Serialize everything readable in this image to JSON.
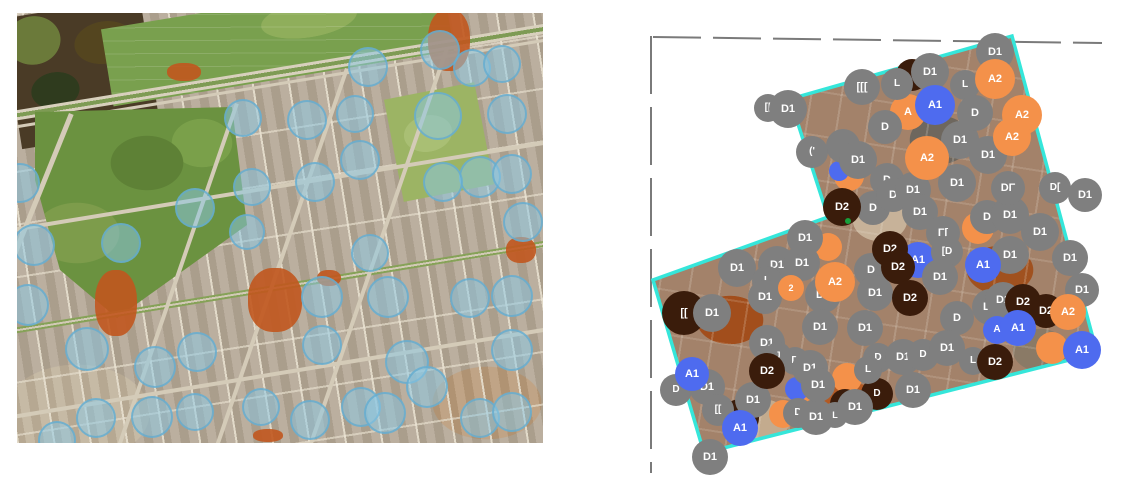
{
  "figure": {
    "left_map": {
      "sample_circle_fill": "rgba(138,200,229,0.52)",
      "sample_circle_edge": "rgba(96,170,206,0.75)",
      "sample_circles": [
        {
          "x": 351,
          "y": 54,
          "r": 20
        },
        {
          "x": 423,
          "y": 37,
          "r": 20
        },
        {
          "x": 455,
          "y": 55,
          "r": 19
        },
        {
          "x": 485,
          "y": 51,
          "r": 19
        },
        {
          "x": 490,
          "y": 101,
          "r": 20
        },
        {
          "x": 226,
          "y": 105,
          "r": 19
        },
        {
          "x": 290,
          "y": 107,
          "r": 20
        },
        {
          "x": 338,
          "y": 101,
          "r": 19
        },
        {
          "x": 421,
          "y": 103,
          "r": 24
        },
        {
          "x": 343,
          "y": 147,
          "r": 20
        },
        {
          "x": 463,
          "y": 164,
          "r": 21
        },
        {
          "x": 426,
          "y": 169,
          "r": 20
        },
        {
          "x": 495,
          "y": 161,
          "r": 20
        },
        {
          "x": 298,
          "y": 169,
          "r": 20
        },
        {
          "x": 235,
          "y": 174,
          "r": 19
        },
        {
          "x": 178,
          "y": 195,
          "r": 20
        },
        {
          "x": 3,
          "y": 170,
          "r": 20
        },
        {
          "x": 104,
          "y": 230,
          "r": 20
        },
        {
          "x": 17,
          "y": 232,
          "r": 21
        },
        {
          "x": 230,
          "y": 219,
          "r": 18
        },
        {
          "x": 11,
          "y": 292,
          "r": 21
        },
        {
          "x": 70,
          "y": 336,
          "r": 22
        },
        {
          "x": 138,
          "y": 354,
          "r": 21
        },
        {
          "x": 180,
          "y": 339,
          "r": 20
        },
        {
          "x": 79,
          "y": 405,
          "r": 20
        },
        {
          "x": 135,
          "y": 404,
          "r": 21
        },
        {
          "x": 178,
          "y": 399,
          "r": 19
        },
        {
          "x": 244,
          "y": 394,
          "r": 19
        },
        {
          "x": 293,
          "y": 407,
          "r": 20
        },
        {
          "x": 344,
          "y": 394,
          "r": 20
        },
        {
          "x": 305,
          "y": 332,
          "r": 20
        },
        {
          "x": 305,
          "y": 284,
          "r": 21
        },
        {
          "x": 371,
          "y": 284,
          "r": 21
        },
        {
          "x": 453,
          "y": 285,
          "r": 20
        },
        {
          "x": 495,
          "y": 283,
          "r": 21
        },
        {
          "x": 390,
          "y": 349,
          "r": 22
        },
        {
          "x": 410,
          "y": 374,
          "r": 21
        },
        {
          "x": 495,
          "y": 337,
          "r": 21
        },
        {
          "x": 463,
          "y": 405,
          "r": 20
        },
        {
          "x": 495,
          "y": 399,
          "r": 20
        },
        {
          "x": 368,
          "y": 400,
          "r": 21
        },
        {
          "x": 506,
          "y": 209,
          "r": 20
        },
        {
          "x": 353,
          "y": 240,
          "r": 19
        },
        {
          "x": 40,
          "y": 427,
          "r": 19
        }
      ]
    },
    "right_map": {
      "boundary_color": "#35e6da",
      "dashed_line_color": "#7a7a7a",
      "green_dot_color": "#18a03c",
      "green_dot": {
        "x": 848,
        "y": 221,
        "r": 3
      },
      "class_colors": {
        "D1": "#7f7f7f",
        "D2": "#3a1c0b",
        "A1": "#4e6bef",
        "A2": "#f4914a"
      },
      "class_names": [
        "D1",
        "D2",
        "A1",
        "A2"
      ],
      "markers": [
        {
          "x": 908,
          "y": 112,
          "r": 18,
          "cls": "A2",
          "label": "A"
        },
        {
          "x": 912,
          "y": 75,
          "r": 16,
          "cls": "D2",
          "label": ""
        },
        {
          "x": 849,
          "y": 176,
          "r": 15,
          "cls": "A2",
          "label": ""
        },
        {
          "x": 839,
          "y": 171,
          "r": 10,
          "cls": "A1",
          "label": ""
        },
        {
          "x": 684,
          "y": 313,
          "r": 22,
          "cls": "D2",
          "label": "[["
        },
        {
          "x": 978,
          "y": 228,
          "r": 16,
          "cls": "A2",
          "label": ""
        },
        {
          "x": 828,
          "y": 247,
          "r": 14,
          "cls": "A2",
          "label": ""
        },
        {
          "x": 918,
          "y": 260,
          "r": 18,
          "cls": "A1",
          "label": "A1"
        },
        {
          "x": 740,
          "y": 418,
          "r": 19,
          "cls": "D2",
          "label": "L"
        },
        {
          "x": 783,
          "y": 414,
          "r": 14,
          "cls": "A2",
          "label": ""
        },
        {
          "x": 808,
          "y": 408,
          "r": 15,
          "cls": "A2",
          "label": ""
        },
        {
          "x": 847,
          "y": 378,
          "r": 15,
          "cls": "A2",
          "label": ""
        },
        {
          "x": 797,
          "y": 389,
          "r": 12,
          "cls": "A1",
          "label": ""
        },
        {
          "x": 1052,
          "y": 348,
          "r": 16,
          "cls": "A2",
          "label": ""
        },
        {
          "x": 845,
          "y": 404,
          "r": 15,
          "cls": "D2",
          "label": "[D"
        },
        {
          "x": 877,
          "y": 394,
          "r": 16,
          "cls": "D2",
          "label": "D"
        },
        {
          "x": 768,
          "y": 108,
          "r": 14,
          "cls": "D1",
          "label": "[["
        },
        {
          "x": 788,
          "y": 109,
          "r": 19,
          "cls": "D1",
          "label": "D1"
        },
        {
          "x": 862,
          "y": 87,
          "r": 18,
          "cls": "D1",
          "label": "[[["
        },
        {
          "x": 897,
          "y": 84,
          "r": 16,
          "cls": "D1",
          "label": "L"
        },
        {
          "x": 930,
          "y": 72,
          "r": 19,
          "cls": "D1",
          "label": "D1"
        },
        {
          "x": 995,
          "y": 52,
          "r": 19,
          "cls": "D1",
          "label": "D1"
        },
        {
          "x": 965,
          "y": 85,
          "r": 15,
          "cls": "D1",
          "label": "L"
        },
        {
          "x": 885,
          "y": 127,
          "r": 17,
          "cls": "D1",
          "label": "D"
        },
        {
          "x": 843,
          "y": 146,
          "r": 17,
          "cls": "D1",
          "label": ""
        },
        {
          "x": 812,
          "y": 152,
          "r": 16,
          "cls": "D1",
          "label": "('"
        },
        {
          "x": 858,
          "y": 160,
          "r": 19,
          "cls": "D1",
          "label": "D1"
        },
        {
          "x": 960,
          "y": 140,
          "r": 19,
          "cls": "D1",
          "label": "D1"
        },
        {
          "x": 975,
          "y": 113,
          "r": 18,
          "cls": "D1",
          "label": "D"
        },
        {
          "x": 988,
          "y": 155,
          "r": 19,
          "cls": "D1",
          "label": "D1"
        },
        {
          "x": 887,
          "y": 180,
          "r": 17,
          "cls": "D1",
          "label": "D"
        },
        {
          "x": 873,
          "y": 208,
          "r": 17,
          "cls": "D1",
          "label": "D"
        },
        {
          "x": 893,
          "y": 195,
          "r": 17,
          "cls": "D1",
          "label": "D"
        },
        {
          "x": 913,
          "y": 190,
          "r": 18,
          "cls": "D1",
          "label": "D1"
        },
        {
          "x": 920,
          "y": 212,
          "r": 18,
          "cls": "D1",
          "label": "D1"
        },
        {
          "x": 957,
          "y": 183,
          "r": 19,
          "cls": "D1",
          "label": "D1"
        },
        {
          "x": 987,
          "y": 217,
          "r": 17,
          "cls": "D1",
          "label": "D"
        },
        {
          "x": 1010,
          "y": 215,
          "r": 19,
          "cls": "D1",
          "label": "D1"
        },
        {
          "x": 1040,
          "y": 232,
          "r": 19,
          "cls": "D1",
          "label": "D1"
        },
        {
          "x": 1008,
          "y": 188,
          "r": 17,
          "cls": "D1",
          "label": "DΓ"
        },
        {
          "x": 1055,
          "y": 188,
          "r": 16,
          "cls": "D1",
          "label": "D["
        },
        {
          "x": 1085,
          "y": 195,
          "r": 17,
          "cls": "D1",
          "label": "D1"
        },
        {
          "x": 1070,
          "y": 258,
          "r": 18,
          "cls": "D1",
          "label": "D1"
        },
        {
          "x": 1082,
          "y": 290,
          "r": 17,
          "cls": "D1",
          "label": "D1"
        },
        {
          "x": 943,
          "y": 233,
          "r": 17,
          "cls": "D1",
          "label": "Γ["
        },
        {
          "x": 947,
          "y": 252,
          "r": 16,
          "cls": "D1",
          "label": "[D"
        },
        {
          "x": 871,
          "y": 270,
          "r": 17,
          "cls": "D1",
          "label": "D"
        },
        {
          "x": 875,
          "y": 293,
          "r": 18,
          "cls": "D1",
          "label": "D1"
        },
        {
          "x": 940,
          "y": 277,
          "r": 18,
          "cls": "D1",
          "label": "D1"
        },
        {
          "x": 1010,
          "y": 255,
          "r": 19,
          "cls": "D1",
          "label": "D1"
        },
        {
          "x": 990,
          "y": 307,
          "r": 18,
          "cls": "D1",
          "label": "D1"
        },
        {
          "x": 1003,
          "y": 300,
          "r": 18,
          "cls": "D1",
          "label": "D1"
        },
        {
          "x": 957,
          "y": 318,
          "r": 17,
          "cls": "D1",
          "label": "D"
        },
        {
          "x": 737,
          "y": 268,
          "r": 19,
          "cls": "D1",
          "label": "D1"
        },
        {
          "x": 777,
          "y": 265,
          "r": 19,
          "cls": "D1",
          "label": "D1"
        },
        {
          "x": 802,
          "y": 263,
          "r": 18,
          "cls": "D1",
          "label": "D1"
        },
        {
          "x": 767,
          "y": 281,
          "r": 15,
          "cls": "D1",
          "label": "L"
        },
        {
          "x": 805,
          "y": 238,
          "r": 18,
          "cls": "D1",
          "label": "D1"
        },
        {
          "x": 712,
          "y": 313,
          "r": 19,
          "cls": "D1",
          "label": "D1"
        },
        {
          "x": 765,
          "y": 297,
          "r": 17,
          "cls": "D1",
          "label": "D1"
        },
        {
          "x": 823,
          "y": 295,
          "r": 18,
          "cls": "D1",
          "label": "D1"
        },
        {
          "x": 865,
          "y": 328,
          "r": 18,
          "cls": "D1",
          "label": "D1"
        },
        {
          "x": 820,
          "y": 327,
          "r": 18,
          "cls": "D1",
          "label": "D1"
        },
        {
          "x": 767,
          "y": 343,
          "r": 18,
          "cls": "D1",
          "label": "D1"
        },
        {
          "x": 778,
          "y": 355,
          "r": 13,
          "cls": "D1",
          "label": "J"
        },
        {
          "x": 795,
          "y": 361,
          "r": 14,
          "cls": "D1",
          "label": "D"
        },
        {
          "x": 676,
          "y": 390,
          "r": 16,
          "cls": "D1",
          "label": "D"
        },
        {
          "x": 707,
          "y": 387,
          "r": 18,
          "cls": "D1",
          "label": "D1"
        },
        {
          "x": 753,
          "y": 400,
          "r": 18,
          "cls": "D1",
          "label": "D1"
        },
        {
          "x": 718,
          "y": 410,
          "r": 16,
          "cls": "D1",
          "label": "[["
        },
        {
          "x": 798,
          "y": 413,
          "r": 15,
          "cls": "D1",
          "label": "D"
        },
        {
          "x": 816,
          "y": 417,
          "r": 18,
          "cls": "D1",
          "label": "D1"
        },
        {
          "x": 835,
          "y": 415,
          "r": 13,
          "cls": "D1",
          "label": "L"
        },
        {
          "x": 710,
          "y": 457,
          "r": 18,
          "cls": "D1",
          "label": "D1"
        },
        {
          "x": 810,
          "y": 368,
          "r": 18,
          "cls": "D1",
          "label": "D1"
        },
        {
          "x": 818,
          "y": 385,
          "r": 17,
          "cls": "D1",
          "label": "D1"
        },
        {
          "x": 878,
          "y": 358,
          "r": 15,
          "cls": "D1",
          "label": "D"
        },
        {
          "x": 903,
          "y": 357,
          "r": 18,
          "cls": "D1",
          "label": "D1"
        },
        {
          "x": 923,
          "y": 355,
          "r": 16,
          "cls": "D1",
          "label": "D"
        },
        {
          "x": 947,
          "y": 348,
          "r": 18,
          "cls": "D1",
          "label": "D1"
        },
        {
          "x": 868,
          "y": 370,
          "r": 14,
          "cls": "D1",
          "label": "L"
        },
        {
          "x": 855,
          "y": 407,
          "r": 18,
          "cls": "D1",
          "label": "D1"
        },
        {
          "x": 913,
          "y": 390,
          "r": 18,
          "cls": "D1",
          "label": "D1"
        },
        {
          "x": 973,
          "y": 361,
          "r": 14,
          "cls": "D1",
          "label": "L"
        },
        {
          "x": 842,
          "y": 207,
          "r": 19,
          "cls": "D2",
          "label": "D2"
        },
        {
          "x": 890,
          "y": 249,
          "r": 18,
          "cls": "D2",
          "label": "D2"
        },
        {
          "x": 898,
          "y": 267,
          "r": 17,
          "cls": "D2",
          "label": "D2"
        },
        {
          "x": 910,
          "y": 298,
          "r": 18,
          "cls": "D2",
          "label": "D2"
        },
        {
          "x": 767,
          "y": 371,
          "r": 18,
          "cls": "D2",
          "label": "D2"
        },
        {
          "x": 1023,
          "y": 302,
          "r": 18,
          "cls": "D2",
          "label": "D2"
        },
        {
          "x": 1046,
          "y": 311,
          "r": 17,
          "cls": "D2",
          "label": "D2"
        },
        {
          "x": 995,
          "y": 362,
          "r": 18,
          "cls": "D2",
          "label": "D2"
        },
        {
          "x": 935,
          "y": 105,
          "r": 20,
          "cls": "A1",
          "label": "A1"
        },
        {
          "x": 983,
          "y": 265,
          "r": 18,
          "cls": "A1",
          "label": "A1"
        },
        {
          "x": 997,
          "y": 330,
          "r": 14,
          "cls": "A1",
          "label": "A"
        },
        {
          "x": 1018,
          "y": 328,
          "r": 18,
          "cls": "A1",
          "label": "A1"
        },
        {
          "x": 1082,
          "y": 350,
          "r": 19,
          "cls": "A1",
          "label": "A1"
        },
        {
          "x": 740,
          "y": 428,
          "r": 18,
          "cls": "A1",
          "label": "A1"
        },
        {
          "x": 692,
          "y": 374,
          "r": 17,
          "cls": "A1",
          "label": "A1"
        },
        {
          "x": 995,
          "y": 79,
          "r": 20,
          "cls": "A2",
          "label": "A2"
        },
        {
          "x": 1022,
          "y": 115,
          "r": 20,
          "cls": "A2",
          "label": "A2"
        },
        {
          "x": 1012,
          "y": 137,
          "r": 19,
          "cls": "A2",
          "label": "A2"
        },
        {
          "x": 927,
          "y": 158,
          "r": 22,
          "cls": "A2",
          "label": "A2"
        },
        {
          "x": 835,
          "y": 282,
          "r": 20,
          "cls": "A2",
          "label": "A2"
        },
        {
          "x": 791,
          "y": 288,
          "r": 13,
          "cls": "A2",
          "label": "2"
        },
        {
          "x": 1068,
          "y": 312,
          "r": 18,
          "cls": "A2",
          "label": "A2"
        }
      ]
    }
  }
}
